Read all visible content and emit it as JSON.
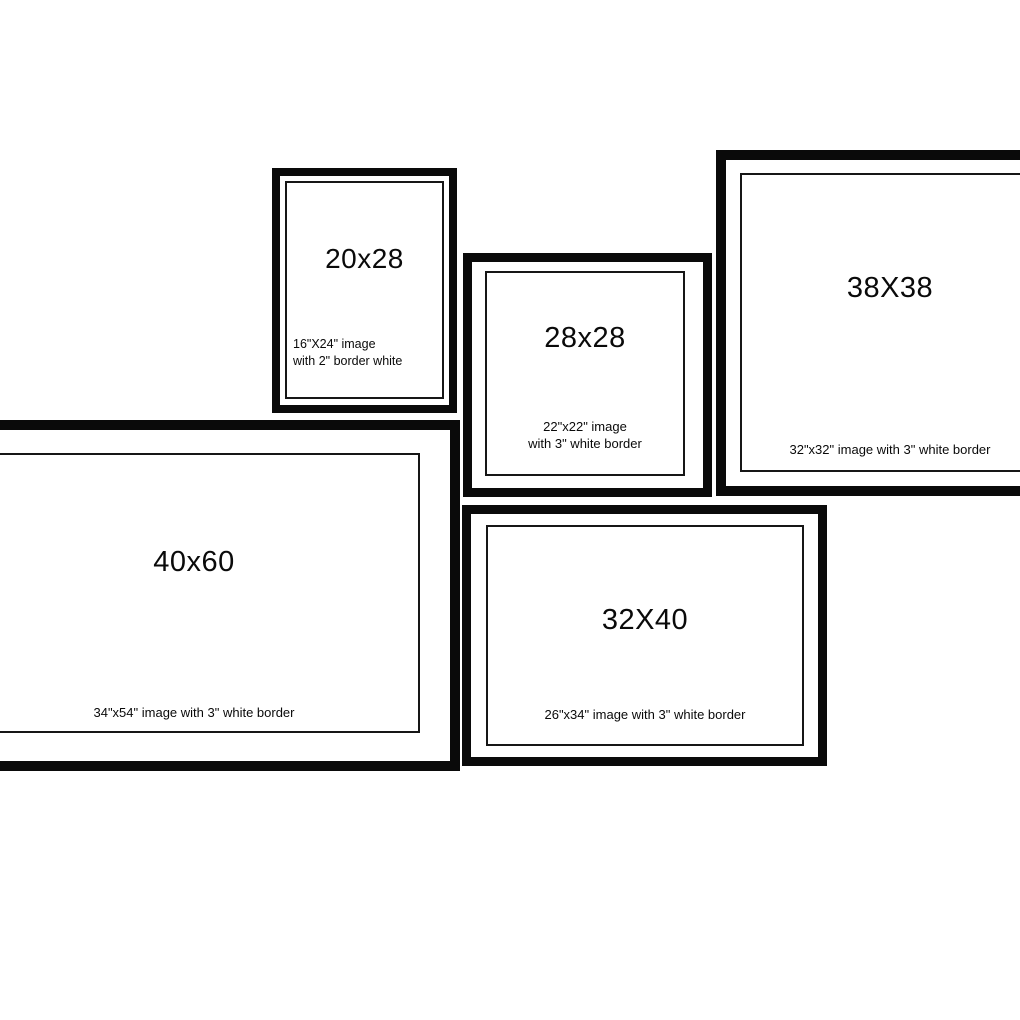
{
  "canvas": {
    "background": "#ffffff",
    "frame_color": "#0a0a0a"
  },
  "frames": [
    {
      "id": "20x28",
      "title": "20x28",
      "caption_line1": "16\"X24\" image",
      "caption_line2": "with 2\" border white"
    },
    {
      "id": "28x28",
      "title": "28x28",
      "caption_line1": "22\"x22\" image",
      "caption_line2": "with 3\" white border"
    },
    {
      "id": "38X38",
      "title": "38X38",
      "caption_line1": "32\"x32\" image with 3\" white border"
    },
    {
      "id": "40x60",
      "title": "40x60",
      "caption_line1": "34\"x54\" image with 3\" white border"
    },
    {
      "id": "32X40",
      "title": "32X40",
      "caption_line1": "26\"x34\" image with 3\" white border"
    }
  ]
}
